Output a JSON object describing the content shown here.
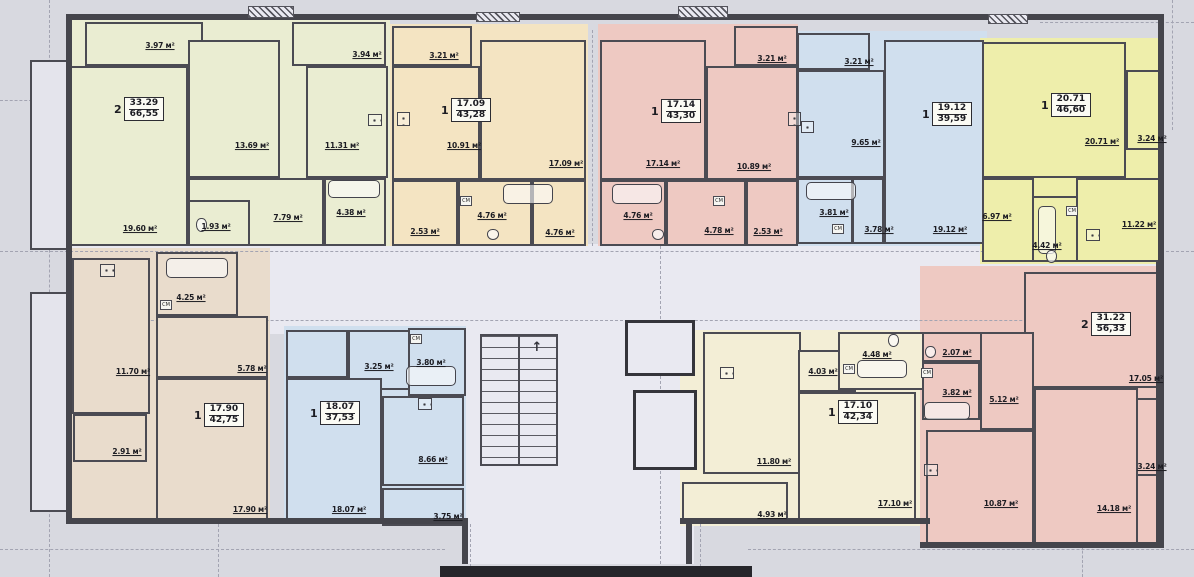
{
  "plan": {
    "width": 1194,
    "height": 577,
    "bg": "#d8d9e0",
    "wall_color": "#45454c",
    "cm_text": "СМ",
    "stairs_arrow": "↑",
    "unit": "м²",
    "base_blocks": [
      {
        "x": 66,
        "y": 244,
        "w": 1096,
        "h": 90,
        "fill": "#e9e9f1"
      },
      {
        "x": 462,
        "y": 292,
        "w": 232,
        "h": 272,
        "fill": "#e9e9f1"
      },
      {
        "x": 68,
        "y": 18,
        "w": 322,
        "h": 228,
        "fill": "#eaedd2"
      },
      {
        "x": 390,
        "y": 24,
        "w": 198,
        "h": 222,
        "fill": "#f4e4c2"
      },
      {
        "x": 598,
        "y": 24,
        "w": 200,
        "h": 222,
        "fill": "#eec9c2"
      },
      {
        "x": 795,
        "y": 31,
        "w": 192,
        "h": 215,
        "fill": "#d0dfee"
      },
      {
        "x": 980,
        "y": 38,
        "w": 184,
        "h": 226,
        "fill": "#eeeeab"
      },
      {
        "x": 70,
        "y": 248,
        "w": 200,
        "h": 272,
        "fill": "#e9dccc"
      },
      {
        "x": 284,
        "y": 326,
        "w": 182,
        "h": 198,
        "fill": "#d0dfee"
      },
      {
        "x": 680,
        "y": 330,
        "w": 248,
        "h": 196,
        "fill": "#f3eed6"
      },
      {
        "x": 920,
        "y": 266,
        "w": 244,
        "h": 280,
        "fill": "#eec9c2"
      }
    ],
    "dashes_h": [
      {
        "x": 0,
        "y": 251,
        "len": 1194
      },
      {
        "x": 66,
        "y": 320,
        "len": 1096
      },
      {
        "x": 0,
        "y": 549,
        "len": 445
      },
      {
        "x": 748,
        "y": 549,
        "len": 446
      },
      {
        "x": 1040,
        "y": 22,
        "len": 154
      },
      {
        "x": 0,
        "y": 100,
        "len": 66
      }
    ],
    "dashes_v": [
      {
        "x": 49,
        "y": 0,
        "len": 577
      },
      {
        "x": 218,
        "y": 524,
        "len": 53
      },
      {
        "x": 470,
        "y": 524,
        "len": 53
      },
      {
        "x": 700,
        "y": 524,
        "len": 53
      },
      {
        "x": 1082,
        "y": 546,
        "len": 31
      },
      {
        "x": 1172,
        "y": 0,
        "len": 130
      },
      {
        "x": 592,
        "y": 30,
        "len": 216
      },
      {
        "x": 660,
        "y": 246,
        "len": 318
      }
    ],
    "rooms": [
      {
        "x": 30,
        "y": 60,
        "w": 38,
        "h": 190,
        "fill": "#e4e4ec"
      },
      {
        "x": 30,
        "y": 292,
        "w": 38,
        "h": 220,
        "fill": "#e4e4ec"
      },
      {
        "x": 85,
        "y": 22,
        "w": 118,
        "h": 44,
        "fill": "#eaedd2"
      },
      {
        "x": 292,
        "y": 22,
        "w": 94,
        "h": 44,
        "fill": "#eaedd2"
      },
      {
        "x": 70,
        "y": 66,
        "w": 118,
        "h": 180,
        "fill": "#eaedd2"
      },
      {
        "x": 188,
        "y": 40,
        "w": 92,
        "h": 138,
        "fill": "#eaedd2"
      },
      {
        "x": 306,
        "y": 66,
        "w": 82,
        "h": 112,
        "fill": "#eaedd2"
      },
      {
        "x": 188,
        "y": 178,
        "w": 136,
        "h": 68,
        "fill": "#eaedd2"
      },
      {
        "x": 188,
        "y": 200,
        "w": 62,
        "h": 46,
        "fill": "#eaedd2"
      },
      {
        "x": 324,
        "y": 178,
        "w": 62,
        "h": 68,
        "fill": "#eaedd2"
      },
      {
        "x": 392,
        "y": 26,
        "w": 80,
        "h": 40,
        "fill": "#f4e4c2"
      },
      {
        "x": 392,
        "y": 66,
        "w": 88,
        "h": 114,
        "fill": "#f4e4c2"
      },
      {
        "x": 480,
        "y": 40,
        "w": 106,
        "h": 140,
        "fill": "#f4e4c2"
      },
      {
        "x": 392,
        "y": 180,
        "w": 66,
        "h": 66,
        "fill": "#f4e4c2"
      },
      {
        "x": 458,
        "y": 180,
        "w": 74,
        "h": 66,
        "fill": "#f4e4c2"
      },
      {
        "x": 532,
        "y": 180,
        "w": 54,
        "h": 66,
        "fill": "#f4e4c2"
      },
      {
        "x": 600,
        "y": 40,
        "w": 106,
        "h": 140,
        "fill": "#eec9c2"
      },
      {
        "x": 706,
        "y": 66,
        "w": 92,
        "h": 114,
        "fill": "#eec9c2"
      },
      {
        "x": 734,
        "y": 26,
        "w": 64,
        "h": 40,
        "fill": "#eec9c2"
      },
      {
        "x": 600,
        "y": 180,
        "w": 66,
        "h": 66,
        "fill": "#eec9c2"
      },
      {
        "x": 666,
        "y": 180,
        "w": 80,
        "h": 66,
        "fill": "#eec9c2"
      },
      {
        "x": 746,
        "y": 180,
        "w": 52,
        "h": 66,
        "fill": "#eec9c2"
      },
      {
        "x": 797,
        "y": 33,
        "w": 73,
        "h": 37,
        "fill": "#d0dfee"
      },
      {
        "x": 797,
        "y": 70,
        "w": 88,
        "h": 108,
        "fill": "#d0dfee"
      },
      {
        "x": 884,
        "y": 40,
        "w": 100,
        "h": 204,
        "fill": "#d0dfee"
      },
      {
        "x": 797,
        "y": 178,
        "w": 56,
        "h": 66,
        "fill": "#d0dfee"
      },
      {
        "x": 852,
        "y": 178,
        "w": 32,
        "h": 66,
        "fill": "#d0dfee"
      },
      {
        "x": 982,
        "y": 42,
        "w": 144,
        "h": 136,
        "fill": "#eeeeab"
      },
      {
        "x": 1126,
        "y": 70,
        "w": 38,
        "h": 80,
        "fill": "#eeeeab"
      },
      {
        "x": 1076,
        "y": 178,
        "w": 86,
        "h": 84,
        "fill": "#eeeeab"
      },
      {
        "x": 982,
        "y": 178,
        "w": 52,
        "h": 84,
        "fill": "#eeeeab"
      },
      {
        "x": 1032,
        "y": 196,
        "w": 46,
        "h": 66,
        "fill": "#eeeeab"
      },
      {
        "x": 72,
        "y": 258,
        "w": 78,
        "h": 156,
        "fill": "#e9dccc"
      },
      {
        "x": 156,
        "y": 252,
        "w": 82,
        "h": 64,
        "fill": "#e9dccc"
      },
      {
        "x": 156,
        "y": 316,
        "w": 112,
        "h": 62,
        "fill": "#e9dccc"
      },
      {
        "x": 156,
        "y": 378,
        "w": 112,
        "h": 142,
        "fill": "#e9dccc"
      },
      {
        "x": 73,
        "y": 414,
        "w": 74,
        "h": 48,
        "fill": "#e9dccc"
      },
      {
        "x": 286,
        "y": 330,
        "w": 62,
        "h": 48,
        "fill": "#d0dfee"
      },
      {
        "x": 348,
        "y": 330,
        "w": 62,
        "h": 60,
        "fill": "#d0dfee"
      },
      {
        "x": 408,
        "y": 328,
        "w": 58,
        "h": 68,
        "fill": "#d0dfee"
      },
      {
        "x": 286,
        "y": 378,
        "w": 96,
        "h": 142,
        "fill": "#d0dfee"
      },
      {
        "x": 382,
        "y": 396,
        "w": 82,
        "h": 90,
        "fill": "#d0dfee"
      },
      {
        "x": 382,
        "y": 488,
        "w": 82,
        "h": 38,
        "fill": "#d0dfee"
      },
      {
        "x": 703,
        "y": 332,
        "w": 98,
        "h": 142,
        "fill": "#f3eed6"
      },
      {
        "x": 798,
        "y": 350,
        "w": 58,
        "h": 42,
        "fill": "#f3eed6"
      },
      {
        "x": 838,
        "y": 332,
        "w": 88,
        "h": 58,
        "fill": "#f3eed6"
      },
      {
        "x": 798,
        "y": 392,
        "w": 118,
        "h": 132,
        "fill": "#f3eed6"
      },
      {
        "x": 682,
        "y": 482,
        "w": 106,
        "h": 42,
        "fill": "#f3eed6"
      },
      {
        "x": 1024,
        "y": 272,
        "w": 138,
        "h": 116,
        "fill": "#eec9c2"
      },
      {
        "x": 1034,
        "y": 388,
        "w": 104,
        "h": 156,
        "fill": "#eec9c2"
      },
      {
        "x": 1136,
        "y": 398,
        "w": 28,
        "h": 78,
        "fill": "#eec9c2"
      },
      {
        "x": 926,
        "y": 430,
        "w": 108,
        "h": 114,
        "fill": "#eec9c2"
      },
      {
        "x": 922,
        "y": 332,
        "w": 60,
        "h": 30,
        "fill": "#eec9c2"
      },
      {
        "x": 922,
        "y": 362,
        "w": 58,
        "h": 58,
        "fill": "#eec9c2"
      },
      {
        "x": 980,
        "y": 332,
        "w": 54,
        "h": 98,
        "fill": "#eec9c2"
      },
      {
        "x": 625,
        "y": 320,
        "w": 70,
        "h": 56,
        "fill": "#e9e9f1",
        "thick": true
      },
      {
        "x": 633,
        "y": 390,
        "w": 64,
        "h": 80,
        "fill": "#e9e9f1",
        "thick": true
      }
    ],
    "walls": [
      {
        "x": 66,
        "y": 14,
        "w": 1098,
        "h": 6
      },
      {
        "x": 66,
        "y": 14,
        "w": 6,
        "h": 510
      },
      {
        "x": 1158,
        "y": 14,
        "w": 6,
        "h": 250
      },
      {
        "x": 1156,
        "y": 262,
        "w": 8,
        "h": 284
      },
      {
        "x": 66,
        "y": 518,
        "w": 402,
        "h": 6
      },
      {
        "x": 680,
        "y": 518,
        "w": 250,
        "h": 6
      },
      {
        "x": 920,
        "y": 542,
        "w": 244,
        "h": 6
      },
      {
        "x": 462,
        "y": 518,
        "w": 6,
        "h": 46
      },
      {
        "x": 686,
        "y": 518,
        "w": 6,
        "h": 46
      }
    ],
    "hatches": [
      {
        "x": 248,
        "y": 6,
        "w": 46,
        "h": 12
      },
      {
        "x": 476,
        "y": 12,
        "w": 44,
        "h": 10
      },
      {
        "x": 678,
        "y": 6,
        "w": 50,
        "h": 12
      },
      {
        "x": 988,
        "y": 14,
        "w": 40,
        "h": 10
      }
    ],
    "stairs": {
      "x": 480,
      "y": 334,
      "w": 78,
      "h": 132
    },
    "canopy": {
      "x": 440,
      "y": 566,
      "w": 312,
      "h": 11,
      "fill": "#26262b"
    },
    "fixtures": [
      {
        "t": "tub",
        "x": 328,
        "y": 180,
        "w": 52,
        "h": 18
      },
      {
        "t": "tub",
        "x": 503,
        "y": 184,
        "w": 50,
        "h": 20
      },
      {
        "t": "tub",
        "x": 612,
        "y": 184,
        "w": 50,
        "h": 20
      },
      {
        "t": "tub",
        "x": 806,
        "y": 182,
        "w": 50,
        "h": 18
      },
      {
        "t": "tub",
        "x": 1038,
        "y": 206,
        "w": 18,
        "h": 48
      },
      {
        "t": "tub",
        "x": 166,
        "y": 258,
        "w": 62,
        "h": 20
      },
      {
        "t": "tub",
        "x": 406,
        "y": 366,
        "w": 50,
        "h": 20
      },
      {
        "t": "tub",
        "x": 857,
        "y": 360,
        "w": 50,
        "h": 18
      },
      {
        "t": "tub",
        "x": 924,
        "y": 402,
        "w": 46,
        "h": 18
      },
      {
        "t": "stove",
        "x": 368,
        "y": 114,
        "w": 14,
        "h": 12
      },
      {
        "t": "stove",
        "x": 397,
        "y": 112,
        "w": 13,
        "h": 14
      },
      {
        "t": "stove",
        "x": 788,
        "y": 112,
        "w": 13,
        "h": 14
      },
      {
        "t": "stove",
        "x": 801,
        "y": 121,
        "w": 13,
        "h": 12
      },
      {
        "t": "stove",
        "x": 1086,
        "y": 229,
        "w": 14,
        "h": 12
      },
      {
        "t": "stove",
        "x": 100,
        "y": 264,
        "w": 15,
        "h": 13
      },
      {
        "t": "stove",
        "x": 418,
        "y": 398,
        "w": 14,
        "h": 12
      },
      {
        "t": "stove",
        "x": 720,
        "y": 367,
        "w": 14,
        "h": 12
      },
      {
        "t": "stove",
        "x": 924,
        "y": 464,
        "w": 14,
        "h": 12
      },
      {
        "t": "wc",
        "x": 196,
        "y": 218,
        "w": 11,
        "h": 14
      },
      {
        "t": "wc",
        "x": 487,
        "y": 229,
        "w": 12,
        "h": 11
      },
      {
        "t": "wc",
        "x": 652,
        "y": 229,
        "w": 12,
        "h": 11
      },
      {
        "t": "wc",
        "x": 1046,
        "y": 250,
        "w": 11,
        "h": 13
      },
      {
        "t": "wc",
        "x": 888,
        "y": 334,
        "w": 11,
        "h": 13
      },
      {
        "t": "wc",
        "x": 925,
        "y": 346,
        "w": 11,
        "h": 12
      }
    ],
    "cm_boxes": [
      {
        "x": 460,
        "y": 196
      },
      {
        "x": 713,
        "y": 196
      },
      {
        "x": 832,
        "y": 224
      },
      {
        "x": 1066,
        "y": 206
      },
      {
        "x": 160,
        "y": 300
      },
      {
        "x": 410,
        "y": 334
      },
      {
        "x": 843,
        "y": 364
      },
      {
        "x": 921,
        "y": 368
      }
    ],
    "labels": [
      {
        "t": "3.97 м²",
        "x": 160,
        "y": 46
      },
      {
        "t": "3.94 м²",
        "x": 367,
        "y": 55
      },
      {
        "t": "13.69 м²",
        "x": 252,
        "y": 146
      },
      {
        "t": "11.31 м²",
        "x": 342,
        "y": 146
      },
      {
        "t": "19.60 м²",
        "x": 140,
        "y": 229
      },
      {
        "t": "1.93 м²",
        "x": 216,
        "y": 227
      },
      {
        "t": "7.79 м²",
        "x": 288,
        "y": 218
      },
      {
        "t": "4.38 м²",
        "x": 351,
        "y": 213
      },
      {
        "t": "3.21 м²",
        "x": 444,
        "y": 56
      },
      {
        "t": "10.91 м²",
        "x": 464,
        "y": 146
      },
      {
        "t": "17.09 м²",
        "x": 566,
        "y": 164
      },
      {
        "t": "2.53 м²",
        "x": 425,
        "y": 232
      },
      {
        "t": "4.76 м²",
        "x": 492,
        "y": 216
      },
      {
        "t": "4.76 м²",
        "x": 560,
        "y": 233
      },
      {
        "t": "3.21 м²",
        "x": 772,
        "y": 59
      },
      {
        "t": "17.14 м²",
        "x": 663,
        "y": 164
      },
      {
        "t": "10.89 м²",
        "x": 754,
        "y": 167
      },
      {
        "t": "4.76 м²",
        "x": 638,
        "y": 216
      },
      {
        "t": "4.78 м²",
        "x": 719,
        "y": 231
      },
      {
        "t": "2.53 м²",
        "x": 768,
        "y": 232
      },
      {
        "t": "3.21 м²",
        "x": 859,
        "y": 62
      },
      {
        "t": "9.65 м²",
        "x": 866,
        "y": 143
      },
      {
        "t": "3.81 м²",
        "x": 834,
        "y": 213
      },
      {
        "t": "3.78 м²",
        "x": 879,
        "y": 230
      },
      {
        "t": "19.12 м²",
        "x": 950,
        "y": 230
      },
      {
        "t": "20.71 м²",
        "x": 1102,
        "y": 142
      },
      {
        "t": "3.24 м²",
        "x": 1152,
        "y": 139
      },
      {
        "t": "6.97 м²",
        "x": 997,
        "y": 217
      },
      {
        "t": "4.42 м²",
        "x": 1047,
        "y": 246
      },
      {
        "t": "11.22 м²",
        "x": 1139,
        "y": 225
      },
      {
        "t": "4.25 м²",
        "x": 191,
        "y": 298
      },
      {
        "t": "11.70 м²",
        "x": 133,
        "y": 372
      },
      {
        "t": "5.78 м²",
        "x": 252,
        "y": 369
      },
      {
        "t": "2.91 м²",
        "x": 127,
        "y": 452
      },
      {
        "t": "17.90 м²",
        "x": 250,
        "y": 510
      },
      {
        "t": "3.25 м²",
        "x": 379,
        "y": 367
      },
      {
        "t": "3.80 м²",
        "x": 431,
        "y": 363
      },
      {
        "t": "8.66 м²",
        "x": 433,
        "y": 460
      },
      {
        "t": "18.07 м²",
        "x": 349,
        "y": 510
      },
      {
        "t": "3.75 м²",
        "x": 448,
        "y": 517
      },
      {
        "t": "4.03 м²",
        "x": 823,
        "y": 372
      },
      {
        "t": "4.48 м²",
        "x": 877,
        "y": 355
      },
      {
        "t": "11.80 м²",
        "x": 774,
        "y": 462
      },
      {
        "t": "17.10 м²",
        "x": 895,
        "y": 504
      },
      {
        "t": "4.93 м²",
        "x": 772,
        "y": 515
      },
      {
        "t": "2.07 м²",
        "x": 957,
        "y": 353
      },
      {
        "t": "3.82 м²",
        "x": 957,
        "y": 393
      },
      {
        "t": "5.12 м²",
        "x": 1004,
        "y": 400
      },
      {
        "t": "10.87 м²",
        "x": 1001,
        "y": 504
      },
      {
        "t": "17.05 м²",
        "x": 1146,
        "y": 379
      },
      {
        "t": "14.18 м²",
        "x": 1114,
        "y": 509
      },
      {
        "t": "3.24 м²",
        "x": 1152,
        "y": 467
      }
    ],
    "info_boxes": [
      {
        "x": 114,
        "y": 97,
        "count": "2",
        "living": "33.29",
        "total": "66,55"
      },
      {
        "x": 441,
        "y": 98,
        "count": "1",
        "living": "17.09",
        "total": "43,28"
      },
      {
        "x": 651,
        "y": 99,
        "count": "1",
        "living": "17.14",
        "total": "43,30"
      },
      {
        "x": 922,
        "y": 102,
        "count": "1",
        "living": "19.12",
        "total": "39,59"
      },
      {
        "x": 1041,
        "y": 93,
        "count": "1",
        "living": "20.71",
        "total": "46,60"
      },
      {
        "x": 194,
        "y": 403,
        "count": "1",
        "living": "17.90",
        "total": "42,75"
      },
      {
        "x": 310,
        "y": 401,
        "count": "1",
        "living": "18.07",
        "total": "37,53"
      },
      {
        "x": 828,
        "y": 400,
        "count": "1",
        "living": "17.10",
        "total": "42,34"
      },
      {
        "x": 1081,
        "y": 312,
        "count": "2",
        "living": "31.22",
        "total": "56,33"
      }
    ]
  }
}
